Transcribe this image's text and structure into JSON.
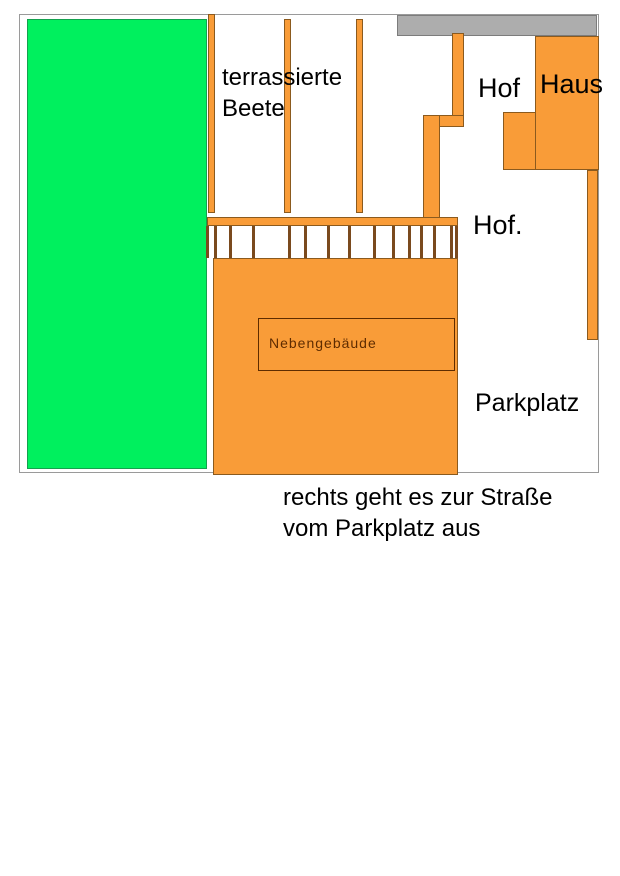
{
  "labels": {
    "terraced_beds_line1": "terrassierte",
    "terraced_beds_line2": "Beete",
    "yard_top": "Hof",
    "house": "Haus",
    "yard_mid": "Hof.",
    "outbuilding": "Nebengebäude",
    "parking": "Parkplatz",
    "caption_line1": "rechts geht es zur Straße",
    "caption_line2": "vom Parkplatz aus"
  },
  "colors": {
    "lawn-green": "#00F05E",
    "lawn-border": "#14A14E",
    "orange-fill": "#F99C38",
    "orange-border": "#8B5A1E",
    "street-gray": "#ADADAD",
    "street-border": "#7C7C7C",
    "frame-gray": "#9A9A9A",
    "picket-brown": "#7A4A1E",
    "outbuilding-text": "#5F2C00",
    "label-black": "#000000"
  },
  "fence": {
    "picket_x": [
      206,
      214,
      229,
      252,
      288,
      304,
      327,
      348,
      373,
      392,
      408,
      420,
      433,
      450,
      455
    ]
  }
}
